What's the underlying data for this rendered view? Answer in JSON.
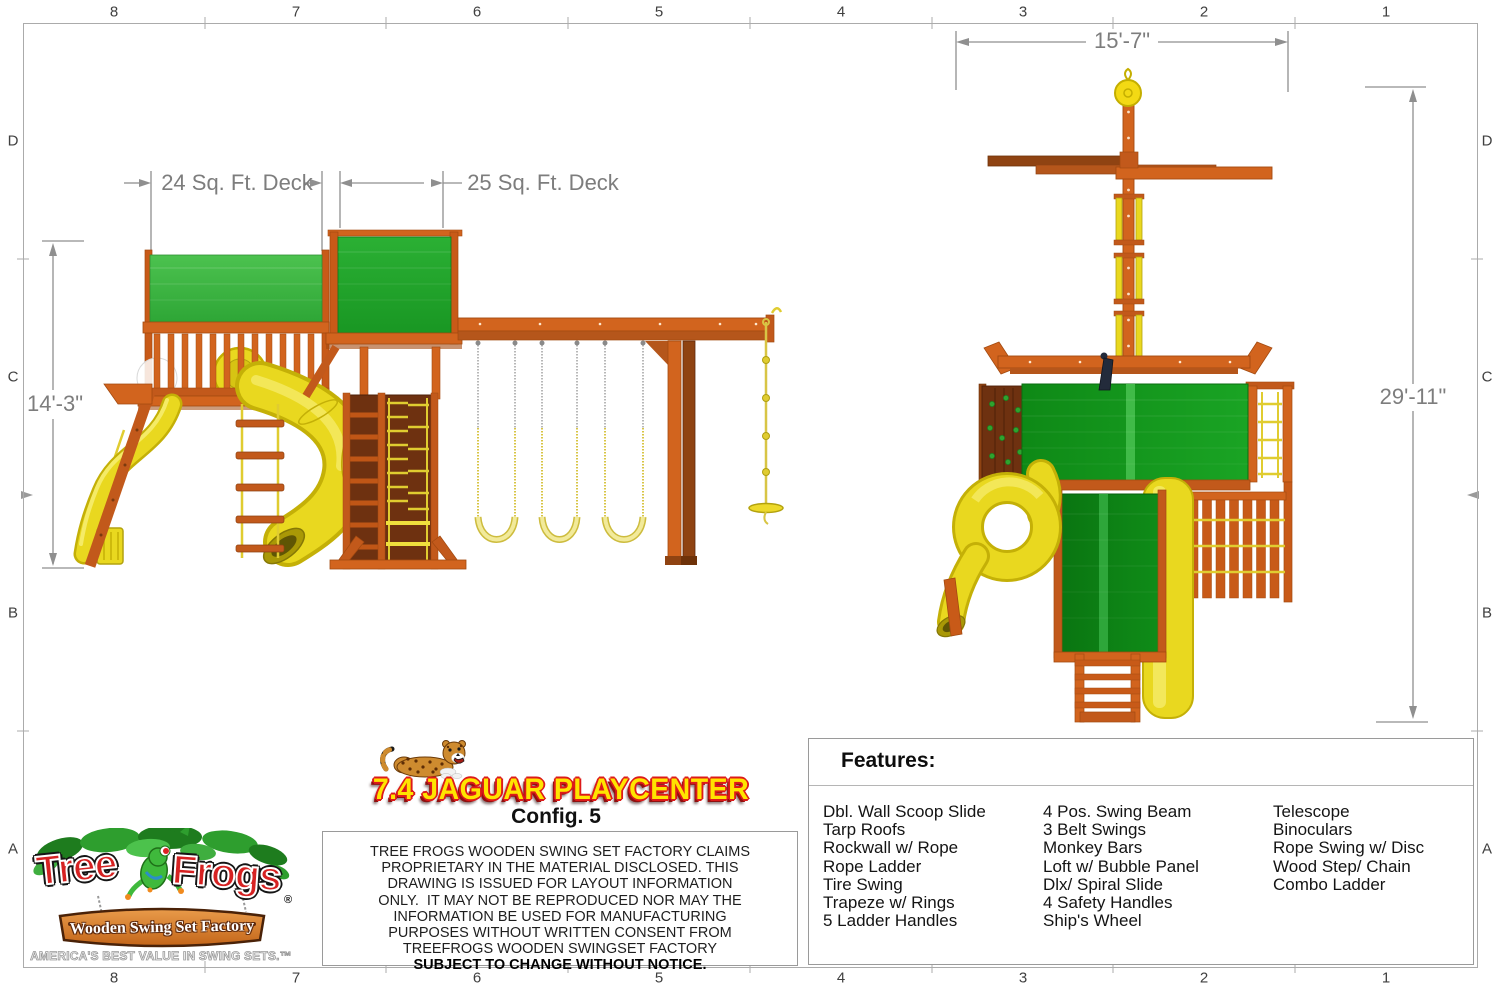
{
  "sheet": {
    "ruler_top": [
      "8",
      "7",
      "6",
      "5",
      "4",
      "3",
      "2",
      "1"
    ],
    "ruler_bottom": [
      "8",
      "7",
      "6",
      "5",
      "4",
      "3",
      "2",
      "1"
    ],
    "ruler_left": [
      "D",
      "C",
      "B",
      "A"
    ],
    "ruler_right": [
      "D",
      "C",
      "B",
      "A"
    ]
  },
  "side_view": {
    "deck1_dim": "24 Sq. Ft. Deck",
    "deck2_dim": "25 Sq. Ft. Deck",
    "height_dim": "14'-3\""
  },
  "end_view": {
    "width_dim": "15'-7\"",
    "height_dim": "29'-11\""
  },
  "title_block": {
    "title": "7.4 JAGUAR PLAYCENTER",
    "config": "Config. 5",
    "disclaimer": [
      "TREE FROGS WOODEN SWING SET FACTORY CLAIMS",
      "PROPRIETARY IN THE MATERIAL DISCLOSED. THIS",
      "DRAWING IS ISSUED FOR LAYOUT INFORMATION",
      "ONLY.  IT MAY NOT BE REPRODUCED NOR MAY THE",
      "INFORMATION BE USED FOR MANUFACTURING",
      "PURPOSES WITHOUT WRITTEN CONSENT FROM",
      "TREEFROGS WOODEN SWINGSET FACTORY"
    ],
    "disclaimer_bold": "SUBJECT TO CHANGE WITHOUT NOTICE."
  },
  "logo": {
    "word1": "Tree",
    "word2": "Frogs",
    "registered": "®",
    "sign": "Wooden Swing Set Factory",
    "tagline": "AMERICA'S BEST VALUE IN SWING SETS.™"
  },
  "features": {
    "heading": "Features:",
    "col1": [
      "Dbl. Wall Scoop Slide",
      "Tarp Roofs",
      "Rockwall w/ Rope",
      "Rope Ladder",
      "Tire Swing",
      "Trapeze w/ Rings",
      "5 Ladder Handles"
    ],
    "col2": [
      "4 Pos. Swing Beam",
      "3 Belt Swings",
      "Monkey Bars",
      "Loft w/ Bubble Panel",
      "Dlx/ Spiral Slide",
      "4 Safety Handles",
      "Ship's Wheel"
    ],
    "col3": [
      "Telescope",
      "Binoculars",
      "Rope Swing w/ Disc",
      "Wood Step/ Chain",
      "Combo Ladder"
    ]
  },
  "colors": {
    "wood": "#d2641e",
    "wood_dark": "#a34a10",
    "wood_deep": "#8f4312",
    "tarp_green_light": "#4cc24f",
    "tarp_green": "#2eae36",
    "tarp_green_dark": "#0e8916",
    "slide_yellow": "#e9d81f",
    "dim_gray": "#8f8f8f",
    "title_yellow": "#ffe400",
    "title_red": "#dd1a1a",
    "logo_red": "#d62222"
  }
}
